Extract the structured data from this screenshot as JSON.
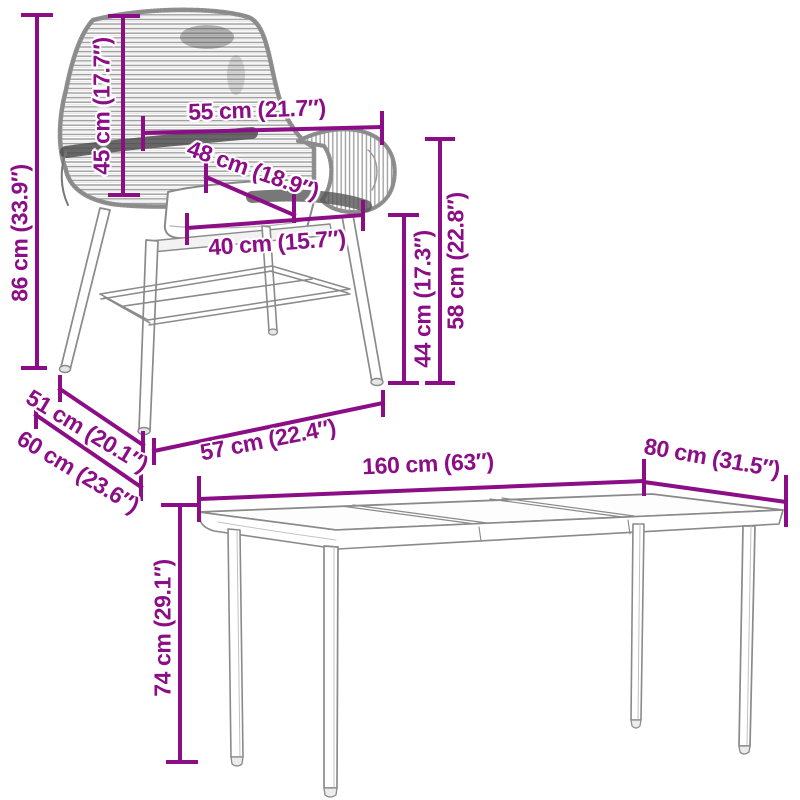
{
  "diagram": {
    "kind": "furniture-dimension-diagram",
    "background": "#ffffff",
    "accent_color": "#8C0E86",
    "artwork_color": "#8a8a8a",
    "items": [
      {
        "name": "wicker-dining-chair",
        "style": "gray line drawing, woven rope texture"
      },
      {
        "name": "glass-top-dining-table",
        "style": "gray line drawing, 3 glass panels, 4 legs"
      }
    ]
  },
  "dims": {
    "chair_total_height": {
      "label": "86 cm (33.9″)",
      "cm": 86,
      "in": 33.9
    },
    "chair_back_height": {
      "label": "45 cm (17.7″)",
      "cm": 45,
      "in": 17.7
    },
    "chair_top_width": {
      "label": "55 cm (21.7″)",
      "cm": 55,
      "in": 21.7
    },
    "chair_seat_diagonal": {
      "label": "48 cm (18.9″)",
      "cm": 48,
      "in": 18.9
    },
    "chair_seat_width": {
      "label": "40 cm (15.7″)",
      "cm": 40,
      "in": 15.7
    },
    "chair_seat_height": {
      "label": "44 cm (17.3″)",
      "cm": 44,
      "in": 17.3
    },
    "chair_arm_height": {
      "label": "58 cm (22.8″)",
      "cm": 58,
      "in": 22.8
    },
    "chair_depth_upper": {
      "label": "51 cm (20.1″)",
      "cm": 51,
      "in": 20.1
    },
    "chair_depth_lower": {
      "label": "60 cm (23.6″)",
      "cm": 60,
      "in": 23.6
    },
    "chair_front_width": {
      "label": "57 cm (22.4″)",
      "cm": 57,
      "in": 22.4
    },
    "table_length": {
      "label": "160 cm (63″)",
      "cm": 160,
      "in": 63
    },
    "table_width": {
      "label": "80 cm (31.5″)",
      "cm": 80,
      "in": 31.5
    },
    "table_height": {
      "label": "74 cm (29.1″)",
      "cm": 74,
      "in": 29.1
    }
  }
}
